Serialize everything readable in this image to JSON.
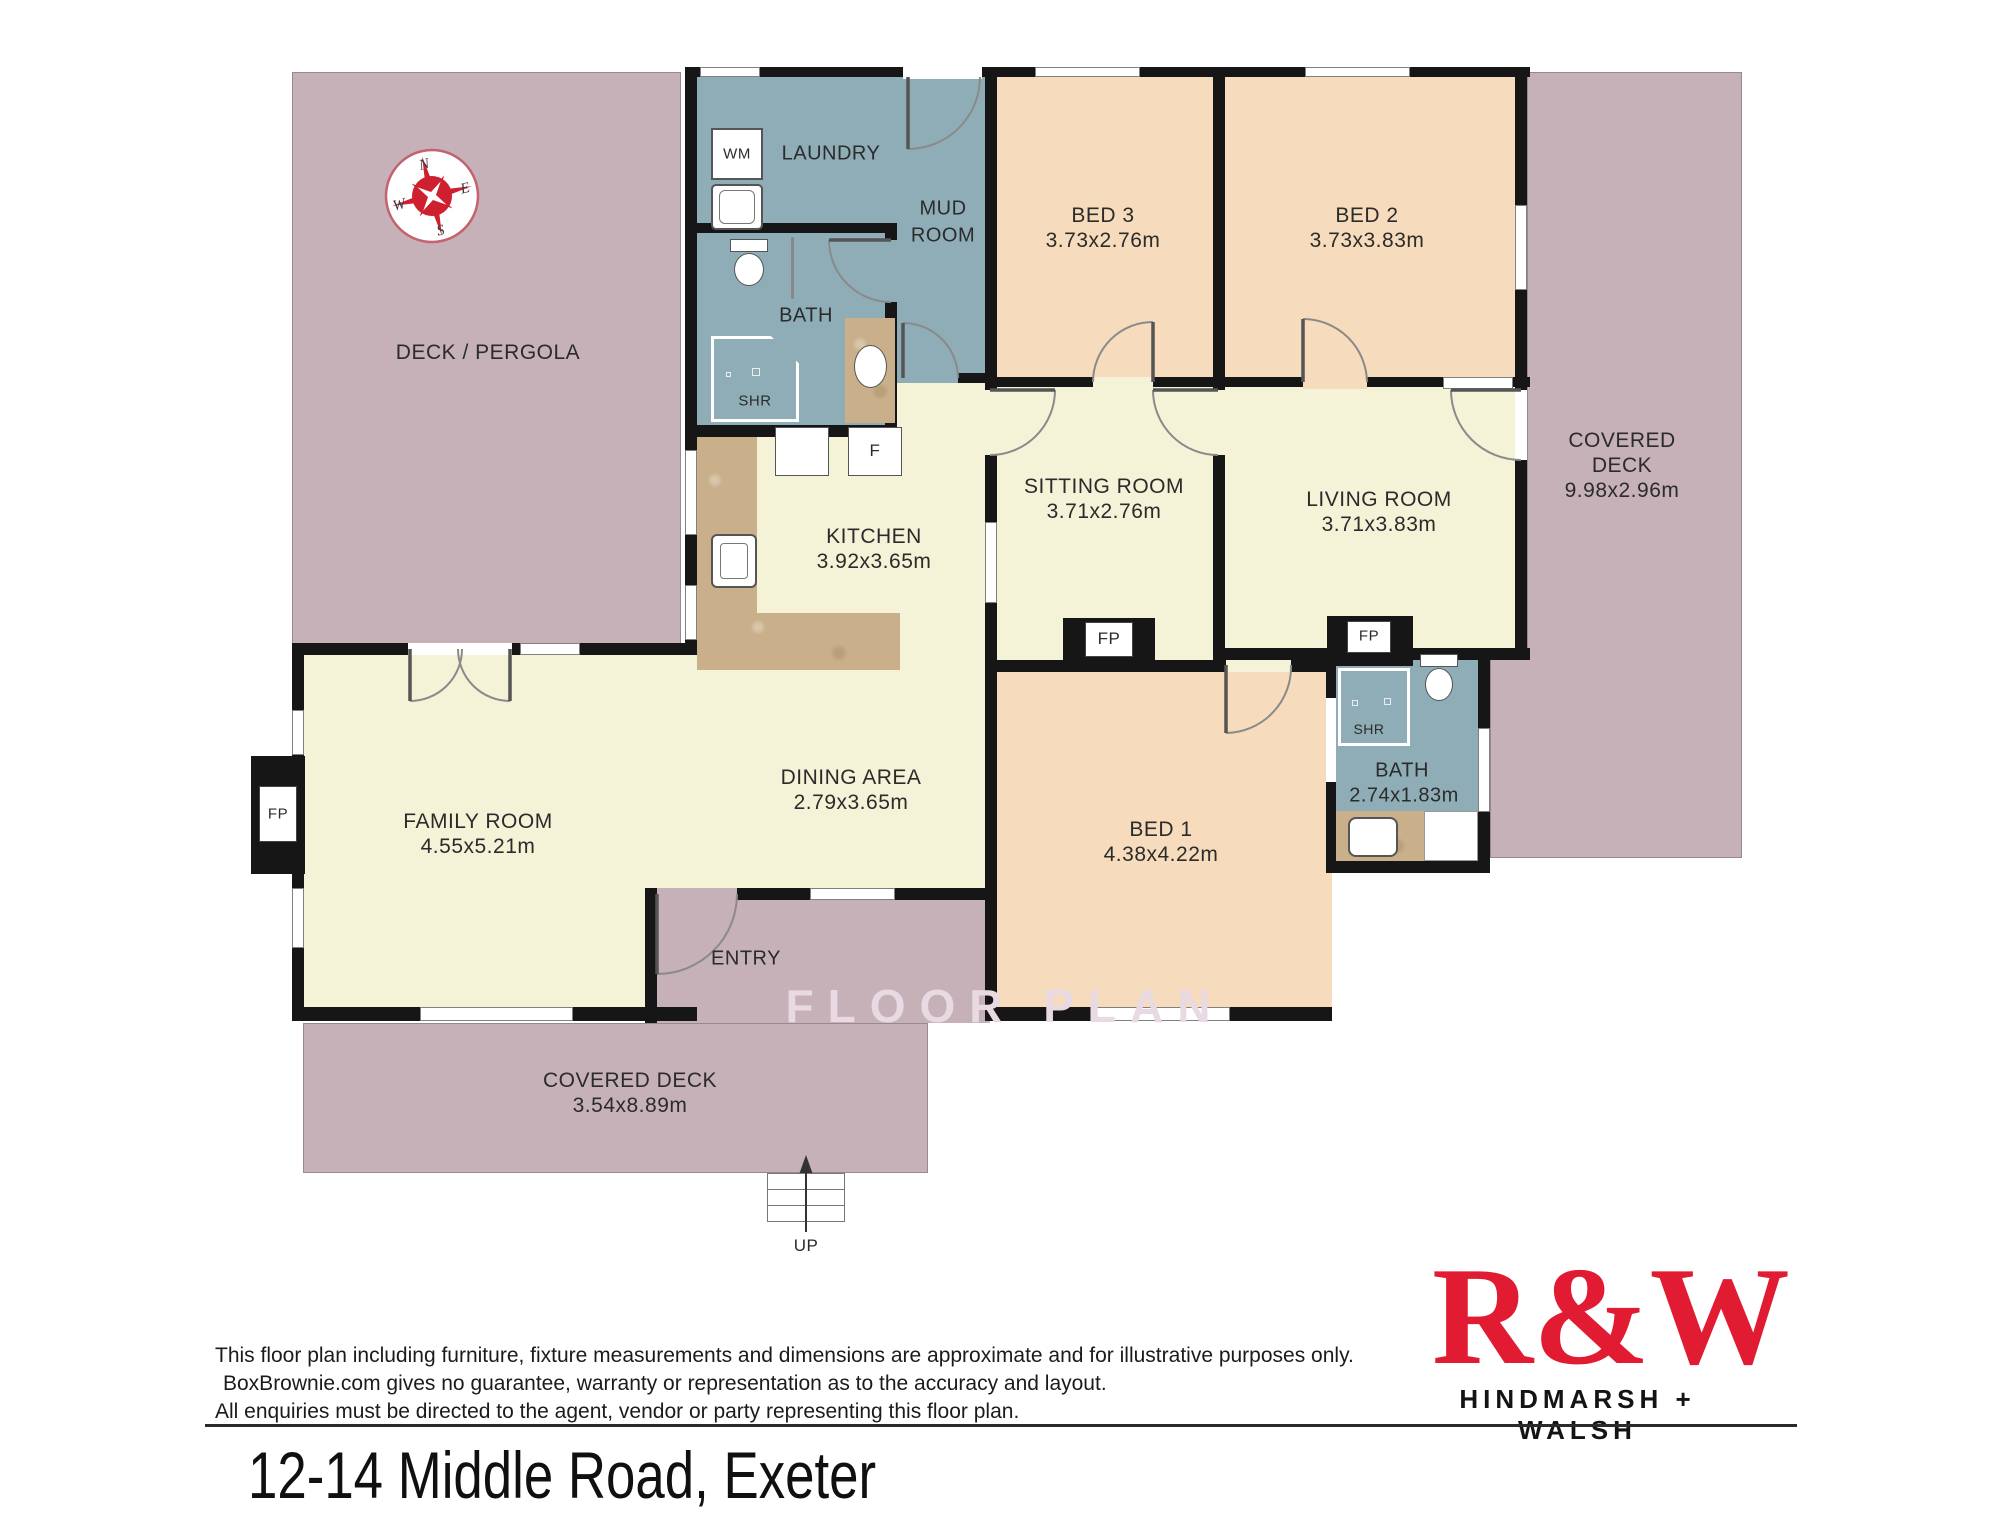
{
  "rooms": {
    "deck_pergola": {
      "name": "DECK / PERGOLA"
    },
    "laundry": {
      "name": "LAUNDRY"
    },
    "mud_room": {
      "line1": "MUD",
      "line2": "ROOM"
    },
    "bath_top": {
      "name": "BATH"
    },
    "shr_top": {
      "name": "SHR"
    },
    "bed3": {
      "name": "BED 3",
      "dims": "3.73x2.76m"
    },
    "bed2": {
      "name": "BED 2",
      "dims": "3.73x3.83m"
    },
    "covered_deck_right": {
      "line1": "COVERED",
      "line2": "DECK",
      "dims": "9.98x2.96m"
    },
    "kitchen": {
      "name": "KITCHEN",
      "dims": "3.92x3.65m"
    },
    "sitting_room": {
      "name": "SITTING ROOM",
      "dims": "3.71x2.76m"
    },
    "living_room": {
      "name": "LIVING ROOM",
      "dims": "3.71x3.83m"
    },
    "family_room": {
      "name": "FAMILY ROOM",
      "dims": "4.55x5.21m"
    },
    "dining_area": {
      "name": "DINING AREA",
      "dims": "2.79x3.65m"
    },
    "bed1": {
      "name": "BED 1",
      "dims": "4.38x4.22m"
    },
    "bath_bottom": {
      "name": "BATH",
      "dims": "2.74x1.83m"
    },
    "shr_bottom": {
      "name": "SHR"
    },
    "entry": {
      "name": "ENTRY"
    },
    "covered_deck_bottom": {
      "name": "COVERED DECK",
      "dims": "3.54x8.89m"
    },
    "up": "UP"
  },
  "fixtures": {
    "wm": "WM",
    "fridge": "F",
    "fp": "FP"
  },
  "compass": {
    "n": "N",
    "e": "E",
    "s": "S",
    "w": "W"
  },
  "watermark": "FLOOR PLAN",
  "footer": {
    "disclaimer_lines": [
      "This floor plan including furniture, fixture measurements and dimensions are approximate and for illustrative purposes only.",
      "BoxBrownie.com gives no guarantee, warranty or representation as to the accuracy and layout.",
      "All enquiries must be directed to the agent, vendor or party representing this floor plan."
    ],
    "brand_logo": "R&W",
    "brand_name": "HINDMARSH + WALSH",
    "address": "12-14 Middle Road, Exeter"
  },
  "colors": {
    "deck_mauve": "#c6b1b8",
    "wet_area_blue": "#8fadb7",
    "living_cream": "#f4f2d7",
    "bedroom_peach": "#f6dcbc",
    "counter_tan": "#c9af8a",
    "wall_black": "#161616",
    "brand_red": "#e11b31"
  }
}
